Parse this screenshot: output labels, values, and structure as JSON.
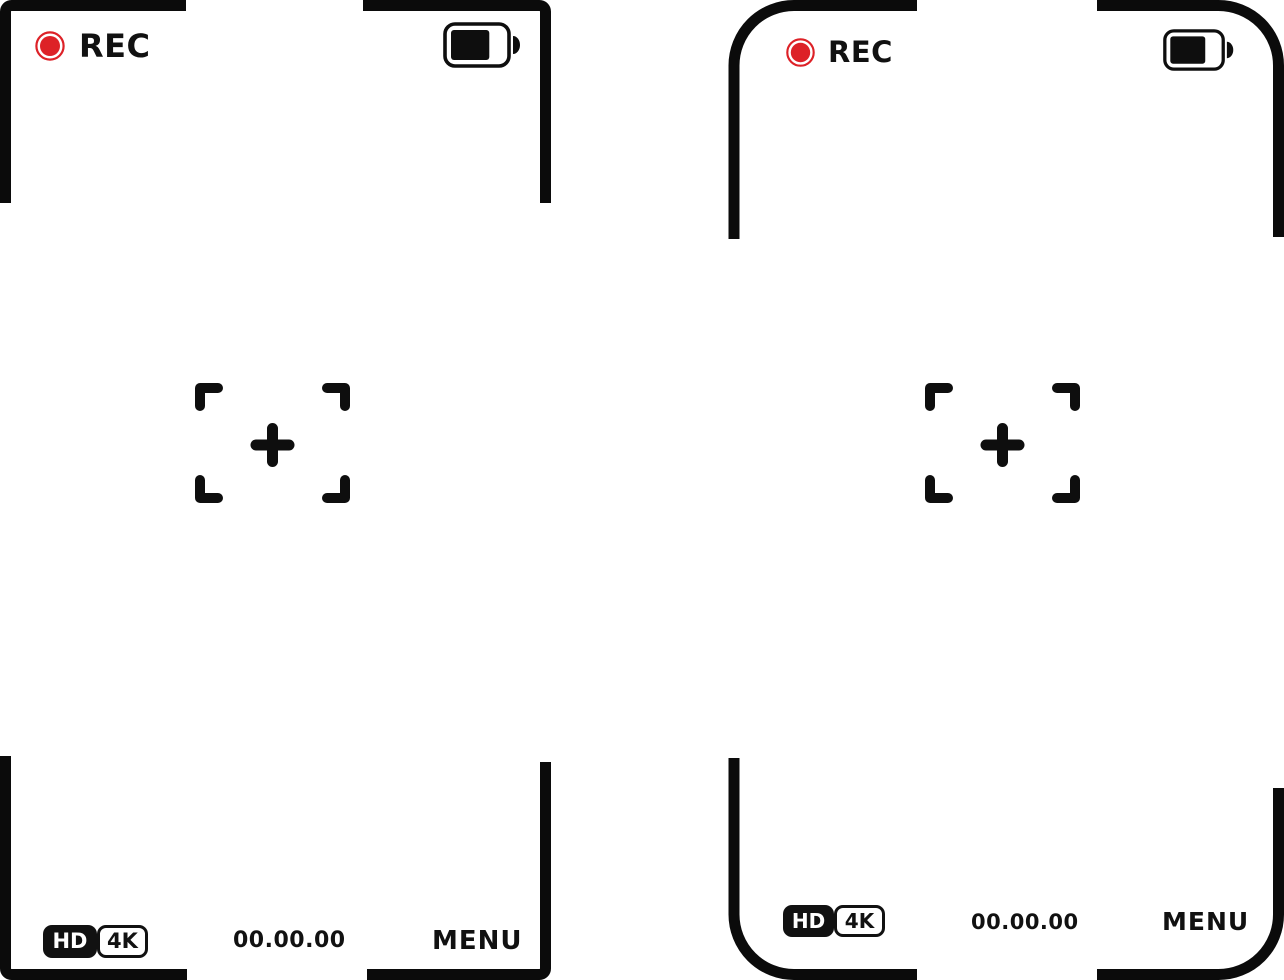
{
  "colors": {
    "record_red": "#dd2127",
    "ink_black": "#111111",
    "background": "#ffffff"
  },
  "panels": [
    {
      "id": "viewfinder-square",
      "style": "square-corners",
      "rec_label": "REC",
      "battery_percent": 75,
      "timecode": "00.00.00",
      "menu_label": "MENU",
      "badges": {
        "hd": "HD",
        "uhd": "4K"
      }
    },
    {
      "id": "viewfinder-rounded",
      "style": "rounded-corners",
      "rec_label": "REC",
      "battery_percent": 75,
      "timecode": "00.00.00",
      "menu_label": "MENU",
      "badges": {
        "hd": "HD",
        "uhd": "4K"
      }
    }
  ]
}
